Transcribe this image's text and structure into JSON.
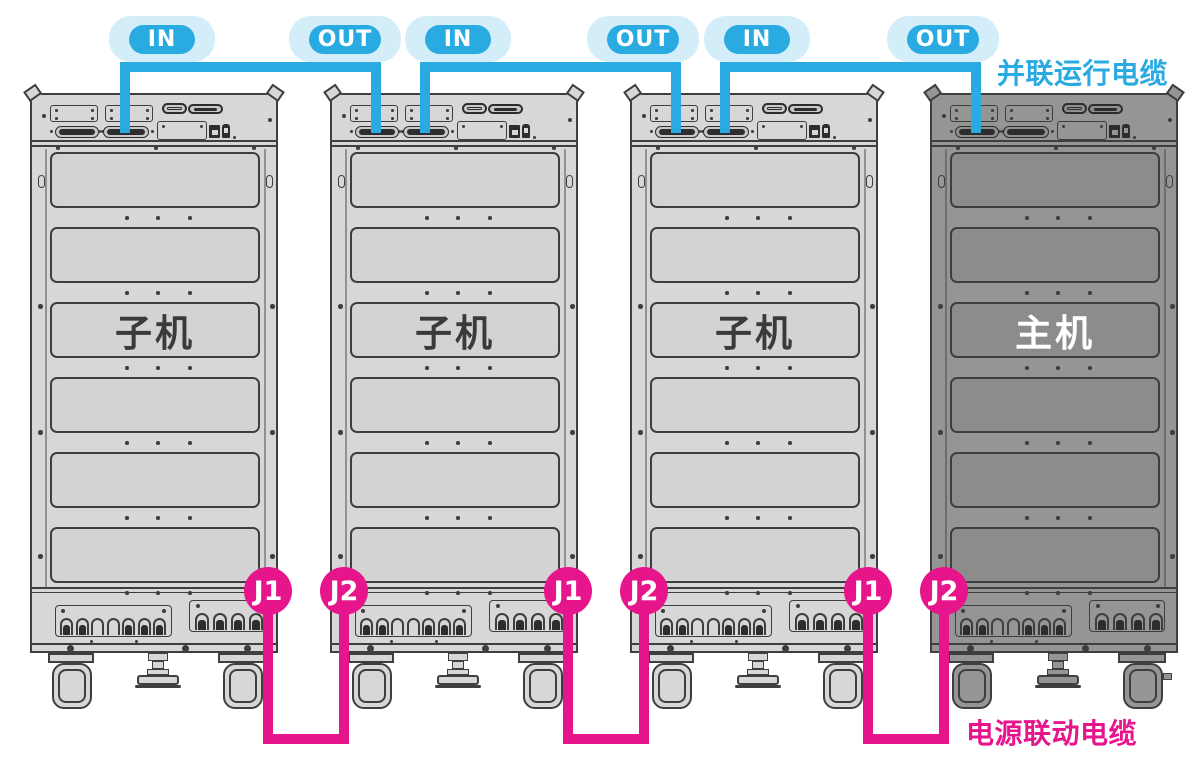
{
  "labels": {
    "parallel_cable": "并联运行电缆",
    "power_link_cable": "电源联动电缆"
  },
  "colors": {
    "cyan": "#29abe2",
    "cyan_halo": "rgba(41,171,226,0.20)",
    "magenta": "#e7158c",
    "cabinet_light": "#d7d7d7",
    "cabinet_dark": "#959595",
    "stroke": "#3e3e3e",
    "label_text_light_cab": "#3a3a3a",
    "label_text_dark_cab": "#ffffff"
  },
  "cabinets": [
    {
      "x": 30,
      "label": "子机",
      "variant": "light"
    },
    {
      "x": 330,
      "label": "子机",
      "variant": "light"
    },
    {
      "x": 630,
      "label": "子机",
      "variant": "light"
    },
    {
      "x": 930,
      "label": "主机",
      "variant": "dark"
    }
  ],
  "parallel_cables": [
    {
      "in_label": "IN",
      "out_label": "OUT",
      "in_x": 125,
      "out_x": 376,
      "in_badge_cx": 162,
      "out_badge_cx": 345
    },
    {
      "in_label": "IN",
      "out_label": "OUT",
      "in_x": 425,
      "out_x": 676,
      "in_badge_cx": 458,
      "out_badge_cx": 643
    },
    {
      "in_label": "IN",
      "out_label": "OUT",
      "in_x": 725,
      "out_x": 976,
      "in_badge_cx": 757,
      "out_badge_cx": 943
    }
  ],
  "power_link_cables": [
    {
      "j1_label": "J1",
      "j2_label": "J2",
      "j1_x": 268,
      "j2_x": 344
    },
    {
      "j1_label": "J1",
      "j2_label": "J2",
      "j1_x": 568,
      "j2_x": 644
    },
    {
      "j1_label": "J1",
      "j2_label": "J2",
      "j1_x": 868,
      "j2_x": 944
    }
  ]
}
